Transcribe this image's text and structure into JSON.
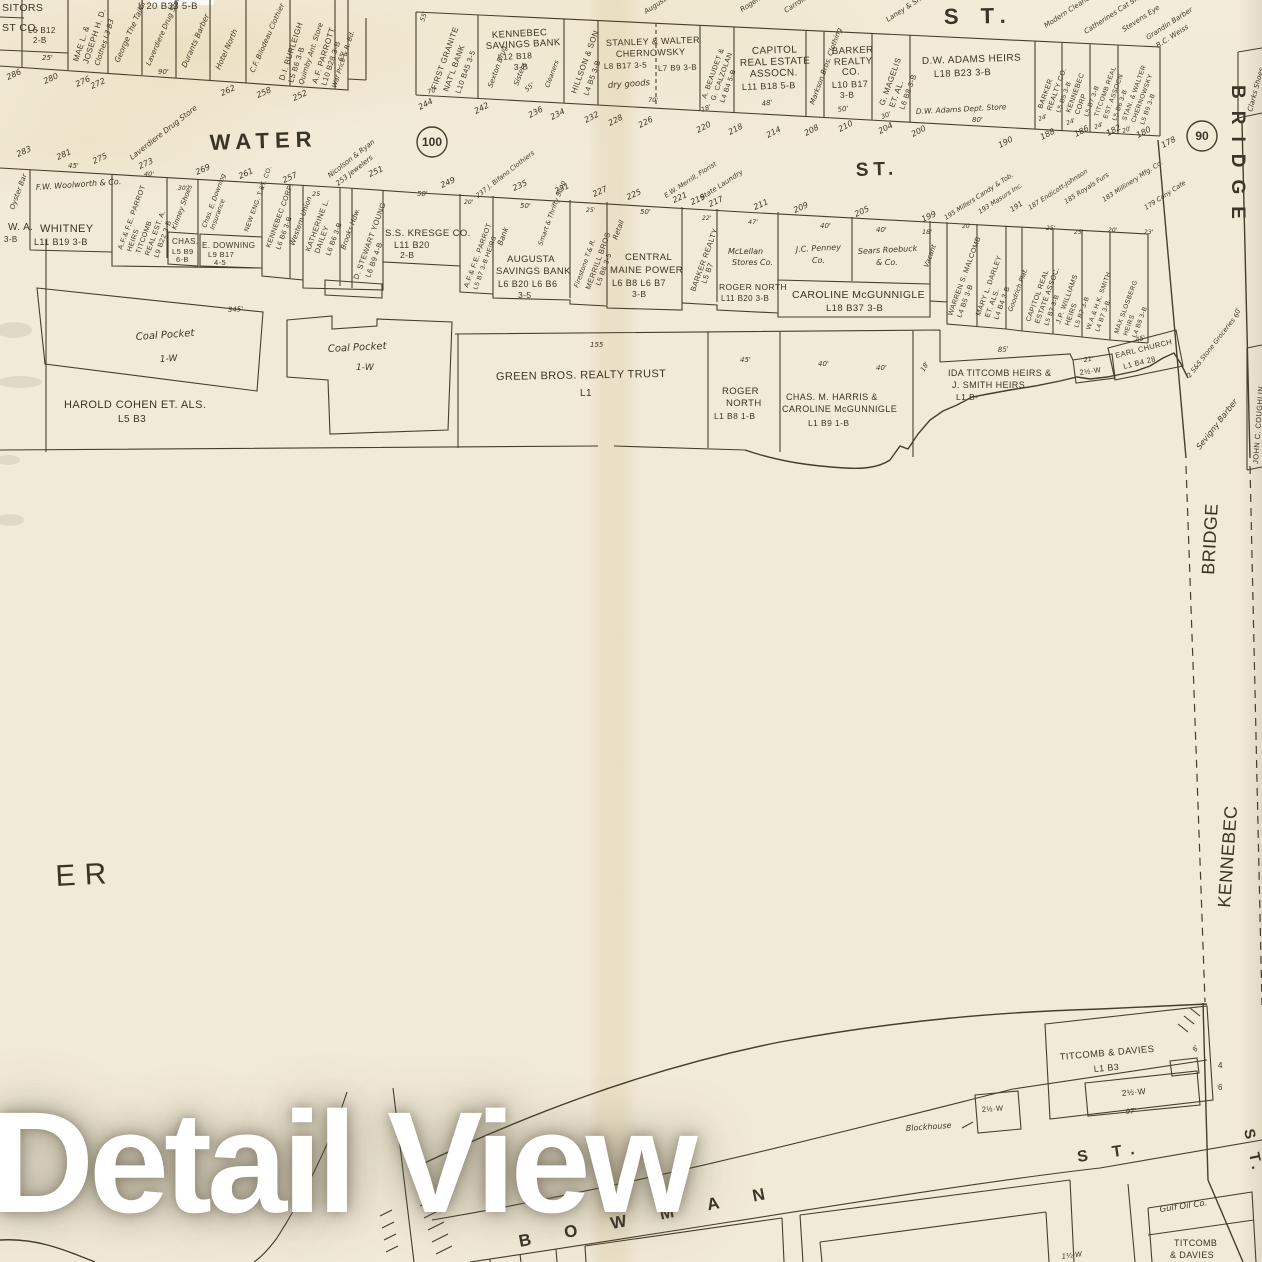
{
  "watermark": "Detail View",
  "streets": {
    "water": "WATER",
    "water_st": "ST.",
    "top_st": "S T.",
    "bridge_big": "BRIDGE",
    "band_bridge": "BRIDGE",
    "band_kennebec": "KENNEBEC",
    "river": "E R",
    "bowman": "BOWMAN",
    "bowman_st": "S T.",
    "side_st": "S T.",
    "c100": "100",
    "c90": "90"
  },
  "nw": {
    "p1": [
      "SITORS",
      "ST CO.",
      "L6 B12",
      "2-B"
    ],
    "p2": [
      "MAE L. &",
      "JOSEPH H. D.",
      "Clothes L3 B3"
    ],
    "p3": "L 20  B33  5-B",
    "shops": [
      "George The Tailor",
      "Laverdiere Drug Store",
      "Durants Barber",
      "Hotel North",
      "C.F. Bilodeau Clothier"
    ],
    "burleigh": [
      "D.I. BURLEIGH",
      "L5 B6 3-B",
      "Quimby Ant. Store"
    ],
    "parrott": [
      "A.F. PARROTT",
      "L10 B28 3-B",
      "War Price & R. Bd."
    ],
    "dims": [
      "25'",
      "90'",
      "65'"
    ],
    "nums": [
      "286",
      "280",
      "276",
      "272",
      "262",
      "258",
      "252"
    ]
  },
  "ne": {
    "granite": [
      "FIRST GRANITE",
      "NAT'L BANK",
      "L10 B45 3-5",
      "55'",
      "70'"
    ],
    "savings": [
      "KENNEBEC",
      "SAVINGS BANK",
      "L12 B18",
      "3-B",
      "Sexton Drug",
      "Sisters",
      "55'",
      "Cleaners"
    ],
    "hillson": [
      "HILLSON & SON",
      "L4 B5 3-B"
    ],
    "stanley": [
      "STANLEY & WALTER",
      "CHERNOWSKY",
      "L8 B17 3-5",
      "L7 B9 3-B",
      "dry goods",
      "70'"
    ],
    "beaudet": [
      "A. BEAUDET &",
      "G. CALZOLAN",
      "L4 B4 5-B",
      "18'"
    ],
    "capitol": [
      "CAPITOL",
      "REAL ESTATE",
      "ASSOCN.",
      "L11 B18 5-B",
      "48'"
    ],
    "markson": "Markson Bros. Clothing",
    "barker": [
      "BARKER",
      "REALTY",
      "CO.",
      "L10 B17",
      "3-B",
      "50'"
    ],
    "magelis": [
      "G. MAGELIS",
      "ET. AL.",
      "L6 B8 3-B",
      "30'"
    ],
    "adams": [
      "D.W. ADAMS HEIRS",
      "L18 B23 3-B",
      "D.W. Adams Dept. Store",
      "80'"
    ],
    "barker2": [
      "BARKER",
      "REALTY CO.",
      "L5 B5 3-B",
      "24'"
    ],
    "kcorp": [
      "KENNEBEC",
      "CORP",
      "L5 B7 3-B",
      "24'"
    ],
    "treal": [
      "TITCOMB REAL",
      "EST. ASSOCN",
      "L5 B6 3-B",
      "24'"
    ],
    "stan2": [
      "STAN. & WALTER",
      "CHERNOWSKY",
      "L5 B9 3-B",
      "20'"
    ],
    "shops": [
      "Augusta Plumbing",
      "Rogers",
      "Carrolls Perfume",
      "Laney & Shoes",
      "Modern Cleaners",
      "Catherines Cat Shop",
      "Stevens Eye",
      "Grandin Barber",
      "R.C. Weiss"
    ],
    "nums": [
      "244",
      "242",
      "236",
      "234",
      "232",
      "228",
      "226",
      "220",
      "218",
      "214",
      "208",
      "210",
      "204",
      "200",
      "190",
      "188",
      "186",
      "182",
      "180",
      "178"
    ]
  },
  "ss": {
    "oyster": [
      "Oyster Bar",
      "3-B"
    ],
    "whitney": [
      "W. A.",
      "WHITNEY",
      "L11 B19 3-B",
      "F.W. Woolworth & Co.",
      "45'"
    ],
    "parrot1": [
      "A.F.& F.E. PARROT",
      "HEIRS",
      "TITCOMB",
      "REAL EST. A.",
      "L9 B22 3-B",
      "40'"
    ],
    "kinney": [
      "Kinney Shoes",
      "CHAS.",
      "L5 B9",
      "6-B",
      "30'"
    ],
    "downing": [
      "Chas. E. Downing",
      "Insurance",
      "E. DOWNING",
      "L9 B17",
      "4-5"
    ],
    "neweng": "NEW ENG. T.&T. CO.",
    "kcorp2": [
      "KENNEBEC CORP.",
      "L6 B6 3-B",
      "Western Union"
    ],
    "dailey": [
      "KATHERINE L.",
      "DAILEY",
      "L6 B6 3-B",
      "25"
    ],
    "brooks": "Brooks Hdw.",
    "young": [
      "D. STEWART YOUNG",
      "L6 B9 4-B"
    ],
    "kresge": [
      "S.S. KRESGE CO.",
      "L11 B20",
      "2-B",
      "50'"
    ],
    "parrot2": [
      "A.F.& F.E. PARROT",
      "L5 B7 3-B HEIRS",
      "20'"
    ],
    "augusta": [
      "AUGUSTA",
      "SAVINGS BANK",
      "L6 B20  L6 B6",
      "3-5",
      "Bank",
      "Smart & Thrifty Shop",
      "50'"
    ],
    "merrill": [
      "Firestone T.& R.",
      "MERRILL BROS",
      "L5 B6 3-5",
      "25'"
    ],
    "cmp": [
      "CENTRAL",
      "MAINE POWER",
      "L6 B8  L6 B7",
      "3-B",
      "Retail",
      "50'"
    ],
    "barker3": [
      "BARKER REALTY",
      "L5 B7",
      "22'"
    ],
    "mclellan": [
      "McLellan",
      "Stores Co.",
      "ROGER NORTH",
      "L11 B20 3-B",
      "47'"
    ],
    "penney": [
      "J.C. Penney",
      "Co.",
      "40'"
    ],
    "sears": [
      "Sears Roebuck",
      "& Co.",
      "40'"
    ],
    "mcgunnigle": [
      "CAROLINE  McGUNNIGLE",
      "L18 B37  3-B"
    ],
    "vacant": [
      "Vacant",
      "18'"
    ],
    "malcomb": [
      "WARREN S. MALCOMB",
      "L4 B5 3-B",
      "20"
    ],
    "darley": [
      "MARY L. DARLEY",
      "ET. ALS.",
      "L4 B4 3-B"
    ],
    "goodrich": "Goodrich Plat.",
    "capitol2": [
      "CAPITOL REAL",
      "ESTATE ASSOC.",
      "L5 B7 3-B",
      "25'"
    ],
    "williams": [
      "J.P. WILLIAMS",
      "HEIRS",
      "L5 B7 3-B",
      "25'"
    ],
    "smith": [
      "W.A.& H.K. SMITH",
      "L4 B7 3-B",
      "20'"
    ],
    "slosberg": [
      "MAX SLOSBERG",
      "HEIRS",
      "L4 B8 3-B",
      "23'"
    ],
    "shops": [
      "Laverdiere Drug Store",
      "Nicolson & Ryan",
      "253 Jewelers",
      "237 J. Bifano Clothiers",
      "E.W. Merrill, Florist",
      "State Laundry",
      "195 Millers Candy & Tob.",
      "193 Masurs Inc.",
      "191",
      "187 Endicott-Johnson",
      "185 Royals Furs",
      "183 Millinery Mfg. Co.",
      "179 Cony Cafe"
    ],
    "nums": [
      "283",
      "281",
      "275",
      "273",
      "269",
      "261",
      "257",
      "251",
      "249",
      "235",
      "231",
      "227",
      "225",
      "221",
      "219",
      "217",
      "211",
      "209",
      "205",
      "199"
    ]
  },
  "rf": {
    "coal1": [
      "Coal Pocket",
      "1-W",
      "345'"
    ],
    "coal2": [
      "Coal Pocket",
      "1-W"
    ],
    "cohen": [
      "HAROLD COHEN  ET. ALS.",
      "L5 B3"
    ],
    "green": [
      "GREEN BROS. REALTY TRUST",
      "L1",
      "155"
    ],
    "rnorth": [
      "ROGER",
      "NORTH",
      "L1 B8 1-B",
      "45'"
    ],
    "harris": [
      "CHAS. M. HARRIS &",
      "CAROLINE McGUNNIGLE",
      "L1 B9  1-B",
      "40'",
      "40'",
      "18'"
    ],
    "ida": [
      "IDA TITCOMB HEIRS &",
      "J. SMITH HEIRS",
      "L1 B-",
      "85'"
    ],
    "wbldg": [
      "2½·W",
      "21'"
    ],
    "church": [
      "EARL CHURCH",
      "L1 B4 28",
      "45'"
    ],
    "groc": "2 S&S Stone Groceries",
    "sevigny": "Sevigny Barber",
    "coughlin": [
      "JOHN C. COUGHLIN",
      "60'"
    ],
    "clarks": "Clarks Shoes"
  },
  "bt": {
    "td": [
      "TITCOMB & DAVIES",
      "L1 B3",
      "2½·W",
      "97'",
      "8'",
      "4",
      "6"
    ],
    "blockhouse": [
      "Blockhouse",
      "2½·W"
    ],
    "gulf": "Gulf Oil Co.",
    "td2": [
      "TITCOMB",
      "& DAVIES"
    ],
    "w15": "1½·W"
  }
}
